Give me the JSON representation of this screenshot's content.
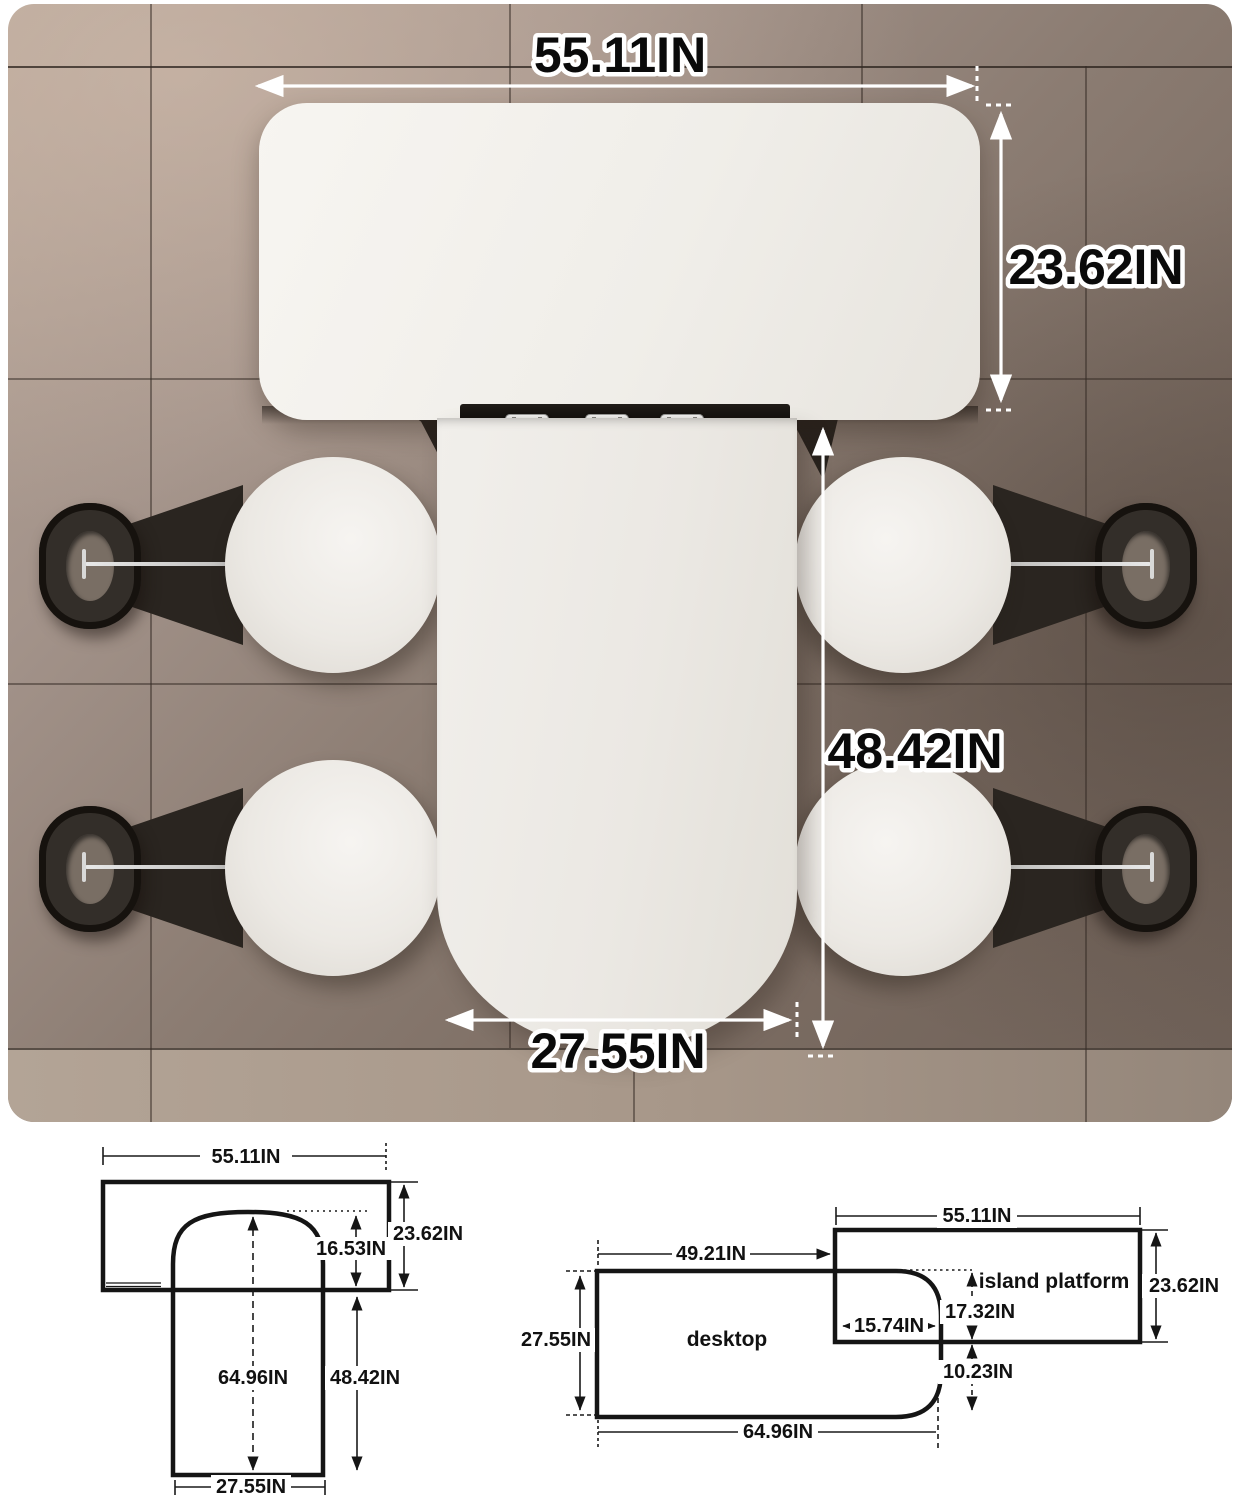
{
  "photo": {
    "dim_top_width": "55.11IN",
    "dim_island_depth": "23.62IN",
    "dim_column_length": "48.42IN",
    "dim_column_width": "27.55IN"
  },
  "left_drawing": {
    "top_width": "55.11IN",
    "island_depth": "23.62IN",
    "dome_inset": "16.53IN",
    "total_length": "64.96IN",
    "column_length": "48.42IN",
    "column_width": "27.55IN"
  },
  "right_drawing": {
    "desktop_offset": "49.21IN",
    "island_width": "55.11IN",
    "desktop_depth": "27.55IN",
    "desktop_label": "desktop",
    "island_label": "island platform",
    "island_depth": "23.62IN",
    "overlap_width": "15.74IN",
    "upper_split": "17.32IN",
    "lower_split": "10.23IN",
    "desktop_length": "64.96IN"
  },
  "colors": {
    "floor": "#8b7c72",
    "tabletop": "#efede9",
    "backrest": "#17130f",
    "annotation_text": "#0a0a0a",
    "annotation_outline": "#ffffff",
    "drawing_line": "#151515"
  }
}
